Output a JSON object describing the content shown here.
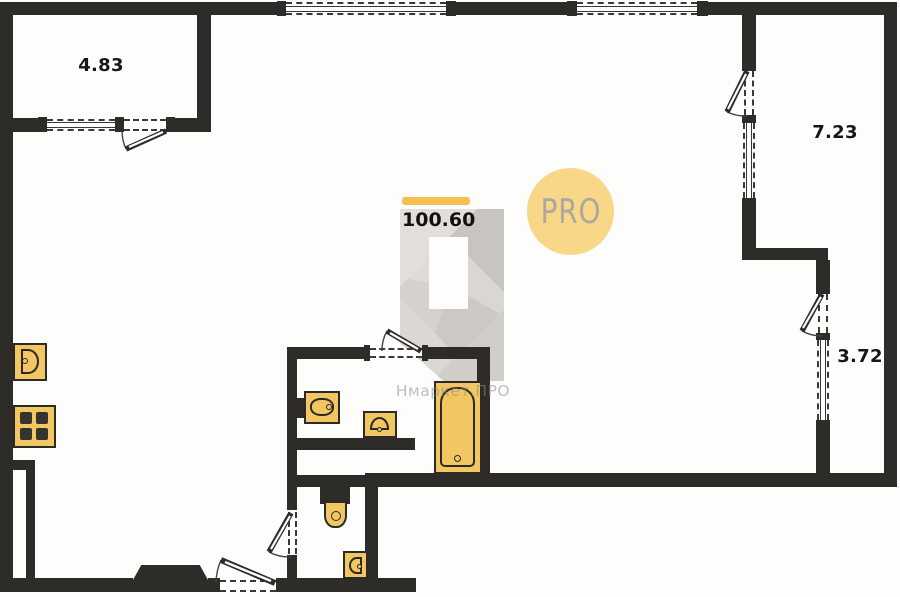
{
  "plan": {
    "type": "apartment-floor-plan",
    "total_area": {
      "value": "100.60"
    },
    "rooms": {
      "loggia_top_left": {
        "area": "4.83"
      },
      "loggia_right_upper": {
        "area": "7.23"
      },
      "loggia_right_lower": {
        "area": "3.72"
      }
    },
    "badge": {
      "label": "PRO"
    },
    "watermark": {
      "brand": "Нмаркет.ПРО"
    },
    "fixtures": [
      "kitchen-sink",
      "stove",
      "washbasin",
      "small-sink",
      "bathtub",
      "toilet",
      "corner-sink"
    ],
    "colors": {
      "wall": "#2e2c29",
      "fixture_fill": "#f2c662",
      "accent_bar": "#f3c04f",
      "badge_bg": "#f8d789",
      "badge_text": "#aba89e",
      "watermark_gray": "#d3cfcb",
      "background": "#fdfdfc"
    }
  }
}
